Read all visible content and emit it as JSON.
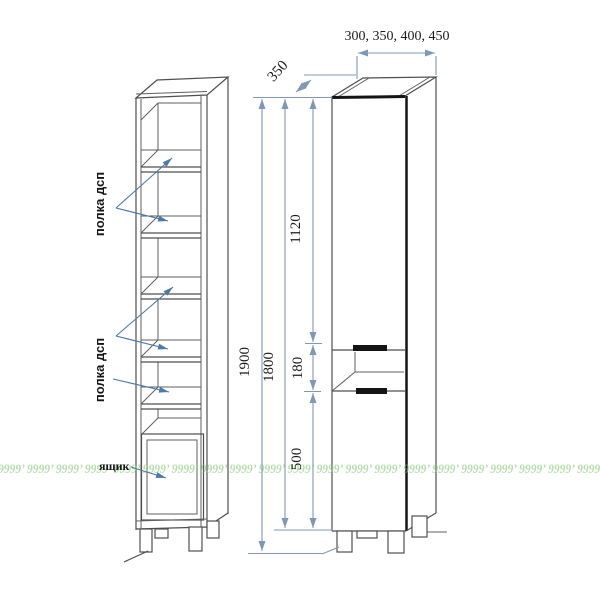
{
  "drawing": {
    "left_unit": {
      "shelf_callout_top": "полка дсп",
      "shelf_callout_bottom": "полка дсп",
      "drawer_callout": "ящик"
    },
    "right_unit": {
      "width_options_label": "300, 350, 400, 450",
      "depth_label": "350",
      "total_height_label": "1900",
      "carcass_height_label": "1800",
      "upper_section_label": "1120",
      "niche_label": "180",
      "lower_section_label": "500"
    },
    "watermark_text": "9999’ 9999’ 9999’ 9999’ 9999’ 9999’ 9999’ 9999’ 9999’ 9999’ 9999’ 9999’ 9999’ 9999’ 9999’ 9999’ 9999’ 9999’ 9999’ 9999’ 9999’"
  },
  "colors": {
    "outline_gray": "#4f4f4f",
    "accent_black": "#141414",
    "dimension_blue": "#7f98b5",
    "pointer_blue": "#4d79a8",
    "watermark_green": "#8cc97e",
    "background": "#ffffff"
  }
}
